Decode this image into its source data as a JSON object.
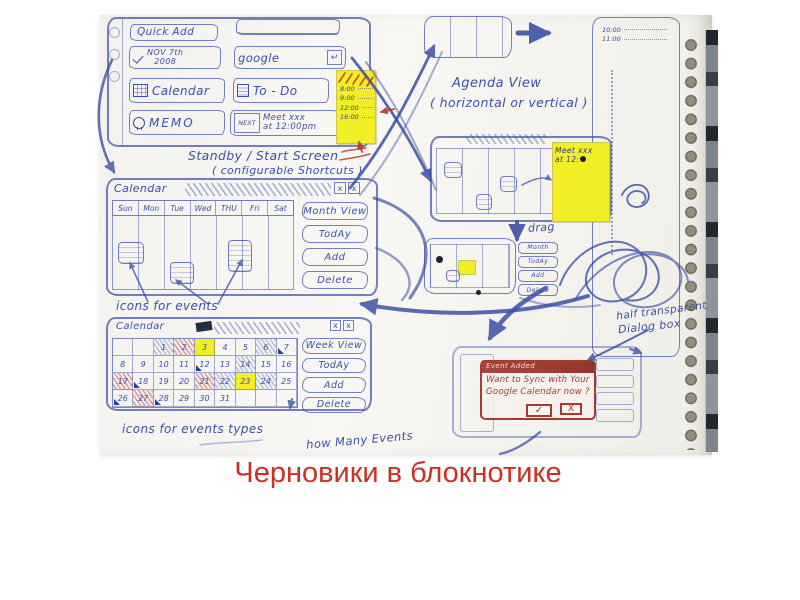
{
  "colors": {
    "pen_blue": "#3c50a8",
    "pen_red": "#b93527",
    "sticky_yellow": "#f2ee25",
    "caption_red": "#cc2f23"
  },
  "caption": "Черновики в блокнотике",
  "start_screen": {
    "quick_add": "Quick Add",
    "date_line1": "NOV 7th",
    "date_line2": "2008",
    "search": "google",
    "return_symbol": "↵",
    "calendar": "Calendar",
    "todo": "To - Do",
    "memo": "MEMO",
    "next_label": "NEXT",
    "next_event_line1": "Meet xxx",
    "next_event_line2": "at 12:00pm",
    "label_line1": "Standby / Start Screen",
    "label_line2": "( configurable Shortcuts )",
    "sticky_times": [
      "8:00",
      "9:00",
      "12:00",
      "16:00"
    ]
  },
  "week_view": {
    "title": "Calendar",
    "close1": "x",
    "close2": "x",
    "days": [
      "Sun",
      "Mon",
      "Tue",
      "Wed",
      "THU",
      "Fri",
      "Sat"
    ],
    "buttons": [
      "Month View",
      "TodAy",
      "Add",
      "Delete"
    ],
    "label": "icons for events"
  },
  "month_view": {
    "title": "Calendar",
    "close1": "x",
    "close2": "x",
    "buttons": [
      "Week View",
      "TodAy",
      "Add",
      "Delete"
    ],
    "cells": [
      {
        "t": ""
      },
      {
        "t": ""
      },
      {
        "t": "1",
        "m": "h"
      },
      {
        "t": "2",
        "m": "r"
      },
      {
        "t": "3",
        "m": "y"
      },
      {
        "t": "4"
      },
      {
        "t": "5"
      },
      {
        "t": "6",
        "m": "h"
      },
      {
        "t": "7",
        "m": "t"
      },
      {
        "t": "8"
      },
      {
        "t": "9"
      },
      {
        "t": "10"
      },
      {
        "t": "11"
      },
      {
        "t": "12",
        "m": "t"
      },
      {
        "t": "13"
      },
      {
        "t": "14",
        "m": "h"
      },
      {
        "t": "15"
      },
      {
        "t": "16"
      },
      {
        "t": "17",
        "m": "r"
      },
      {
        "t": "18",
        "m": "t"
      },
      {
        "t": "19"
      },
      {
        "t": "20"
      },
      {
        "t": "21",
        "m": "r"
      },
      {
        "t": "22",
        "m": "h"
      },
      {
        "t": "23",
        "m": "y"
      },
      {
        "t": "24",
        "m": "h"
      },
      {
        "t": "25"
      },
      {
        "t": "26",
        "m": "t"
      },
      {
        "t": "27",
        "m": "r"
      },
      {
        "t": "28",
        "m": "t"
      },
      {
        "t": "29"
      },
      {
        "t": "30"
      },
      {
        "t": "31"
      },
      {
        "t": ""
      },
      {
        "t": ""
      },
      {
        "t": ""
      }
    ],
    "label_line1": "icons for events types",
    "label_line2": "how Many Events"
  },
  "agenda": {
    "label_line1": "Agenda View",
    "label_line2": "( horizontal or vertical )",
    "times": [
      "10:00",
      "11:00"
    ]
  },
  "meeting_sticky": {
    "line1": "Meet xxx",
    "line2": "at 12:"
  },
  "drag_label": "drag",
  "mini_view": {
    "buttons": [
      "Month",
      "TodAy",
      "Add",
      "Delete"
    ]
  },
  "dialog": {
    "title": "Event Added",
    "body": "Want to Sync with Your Google Calendar now ?",
    "ok_symbol": "✓",
    "close_symbol": "X",
    "annotation_line1": "half transparent",
    "annotation_line2": "Dialog box"
  }
}
